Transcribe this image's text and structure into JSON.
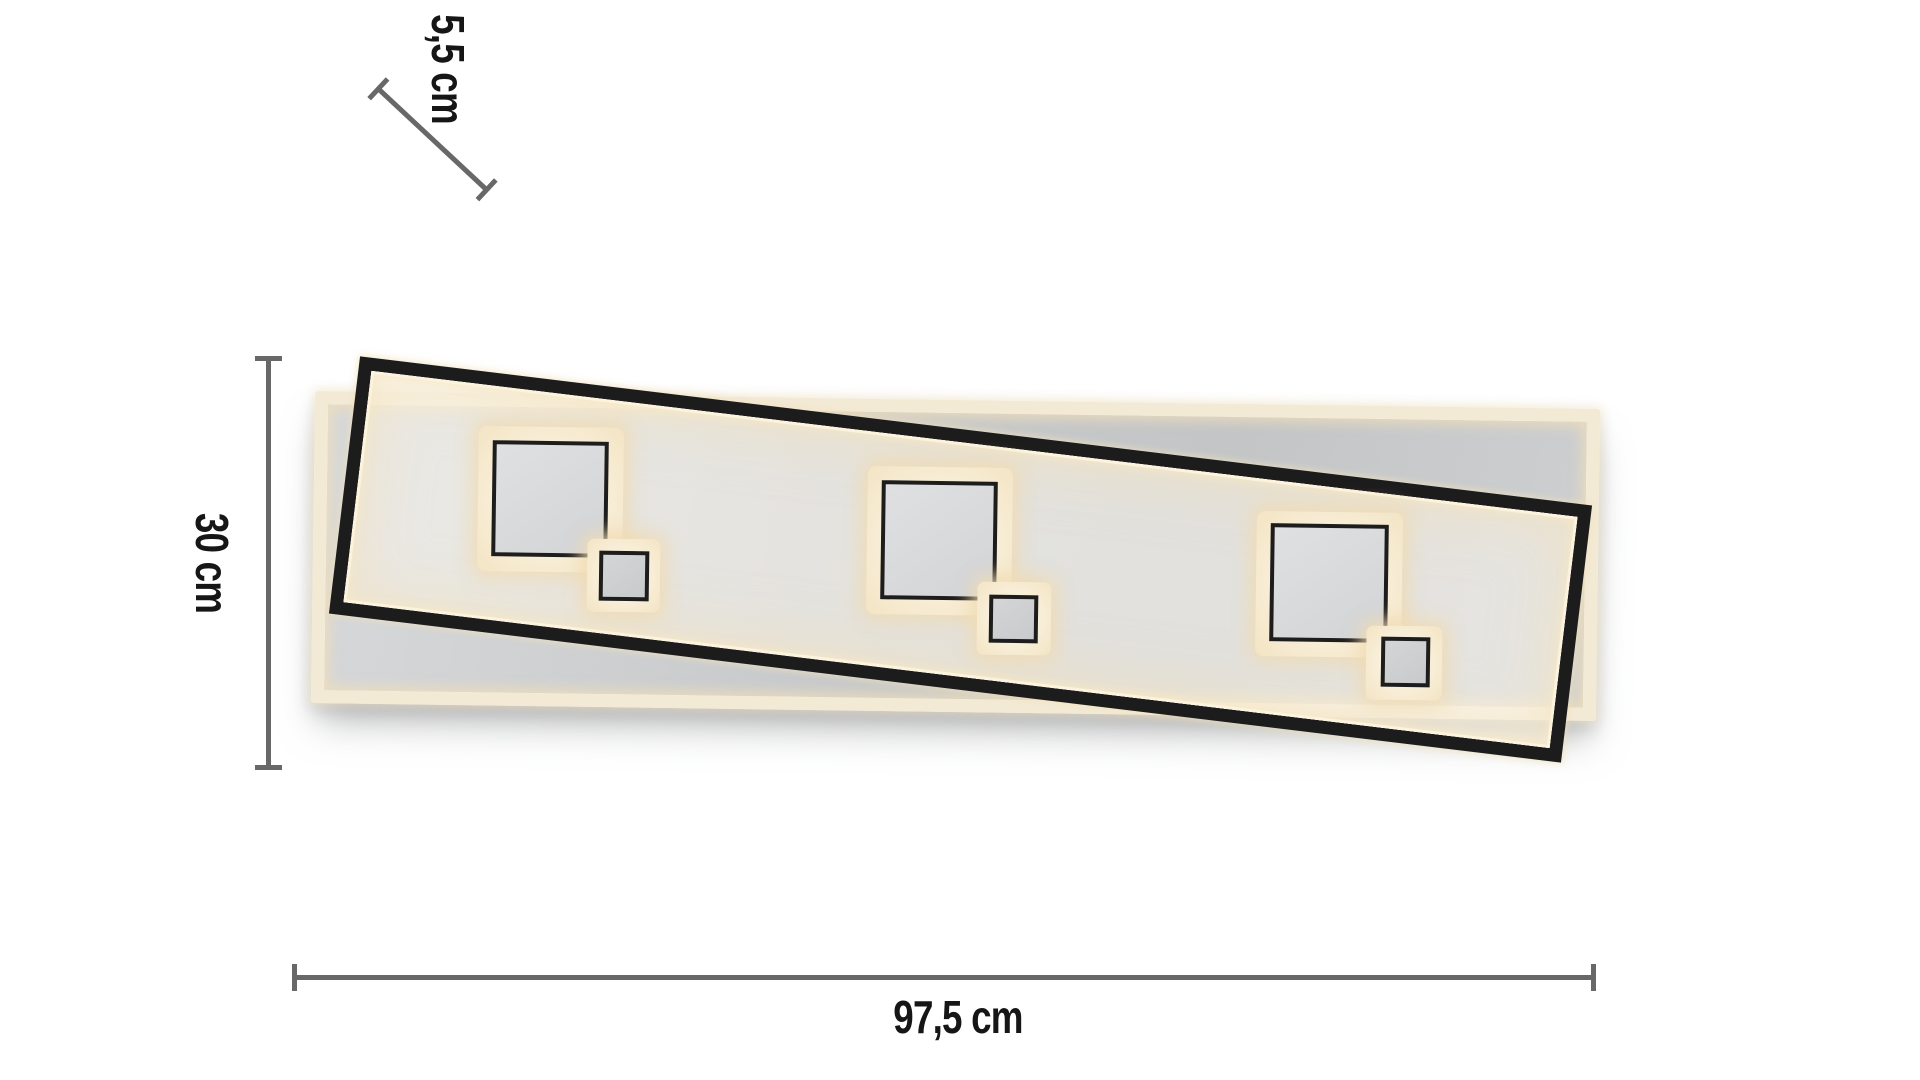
{
  "diagram": {
    "type": "product-dimension-diagram",
    "product": "LED ceiling light with two offset rectangular frames and three pairs of backlit squares",
    "dimensions": {
      "depth": {
        "label": "5,5 cm"
      },
      "height": {
        "label": "30 cm"
      },
      "width": {
        "label": "97,5 cm"
      }
    },
    "colors": {
      "frame_black": "#1c1c1c",
      "glow_warm": "#f3e4c3",
      "panel_gray": "#c6c8ca",
      "dimension_line": "#686868",
      "label_text": "#161616",
      "background": "#ffffff"
    }
  }
}
